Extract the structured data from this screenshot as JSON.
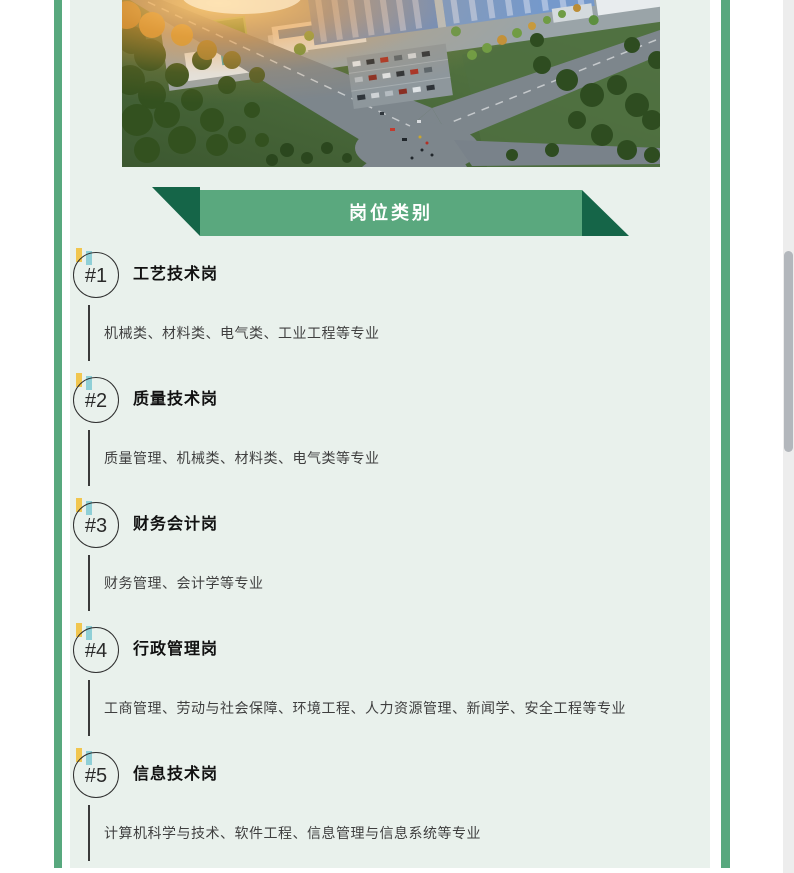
{
  "colors": {
    "accent_green": "#58a87e",
    "ribbon_green": "#5aa87e",
    "ribbon_fold_dark_green": "#156548",
    "panel_background": "#e9f1ec",
    "badge_yellow": "#f1c64f",
    "badge_teal": "#8fcfd6"
  },
  "hero": {
    "label": "industrial-campus-aerial-rendering"
  },
  "ribbon": {
    "title": "岗位类别"
  },
  "jobs": [
    {
      "num": "#1",
      "title": "工艺技术岗",
      "majors": "机械类、材料类、电气类、工业工程等专业"
    },
    {
      "num": "#2",
      "title": "质量技术岗",
      "majors": "质量管理、机械类、材料类、电气类等专业"
    },
    {
      "num": "#3",
      "title": "财务会计岗",
      "majors": "财务管理、会计学等专业"
    },
    {
      "num": "#4",
      "title": "行政管理岗",
      "majors": "工商管理、劳动与社会保障、环境工程、人力资源管理、新闻学、安全工程等专业"
    },
    {
      "num": "#5",
      "title": "信息技术岗",
      "majors": "计算机科学与技术、软件工程、信息管理与信息系统等专业"
    }
  ]
}
